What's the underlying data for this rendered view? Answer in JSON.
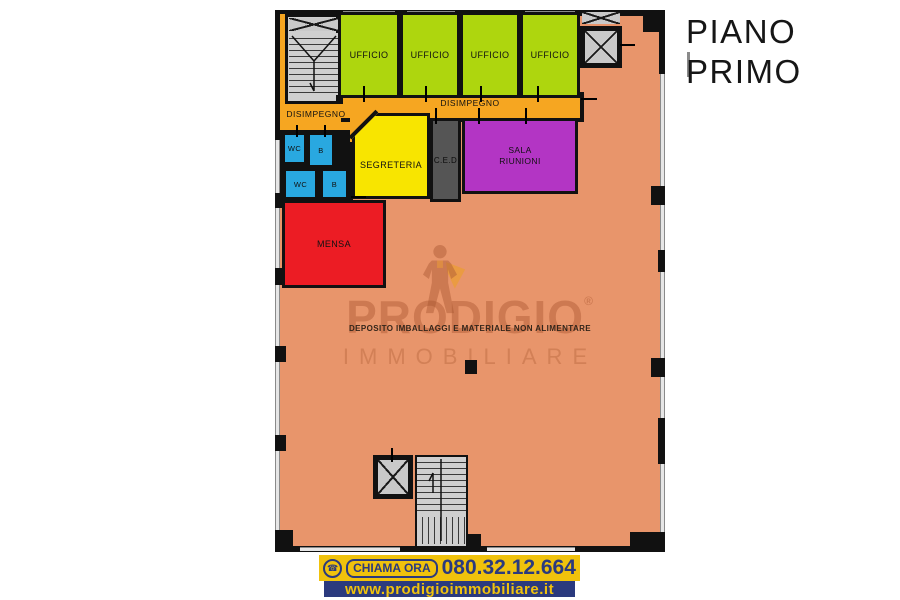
{
  "title": {
    "line1": "PIANO",
    "line2": "PRIMO"
  },
  "floorplan": {
    "offices": [
      {
        "label": "UFFICIO"
      },
      {
        "label": "UFFICIO"
      },
      {
        "label": "UFFICIO"
      },
      {
        "label": "UFFICIO"
      }
    ],
    "disimpegno_left": {
      "label": "DISIMPEGNO"
    },
    "disimpegno_top": {
      "label": "DISIMPEGNO"
    },
    "wc_top": {
      "label": "WC"
    },
    "bath_top": {
      "label": "B"
    },
    "wc_bottom": {
      "label": "WC"
    },
    "bath_bottom": {
      "label": "B"
    },
    "segreteria": {
      "label": "SEGRETERIA"
    },
    "ced": {
      "label": "C.E.D"
    },
    "sala_riunioni": {
      "label": "SALA RIUNIONI"
    },
    "mensa": {
      "label": "MENSA"
    },
    "deposito": {
      "label": "DEPOSITO IMBALLAGGI E MATERIALE NON ALIMENTARE"
    }
  },
  "watermark": {
    "brand": "PRODIGIO",
    "registered": "®",
    "brand_sub": "IMMOBILIARE"
  },
  "footer": {
    "cta_label": "CHIAMA ORA",
    "phone_number": "080.32.12.664",
    "website": "www.prodigioimmobiliare.it"
  },
  "colors": {
    "office_green": "#aed60e",
    "corridor_orange": "#f6a621",
    "segreteria_yellow": "#f8e500",
    "ced_gray": "#555555",
    "meeting_purple": "#b335c4",
    "wc_blue": "#29a8e0",
    "mensa_red": "#ec1c24",
    "deposito_salmon": "#e8956b",
    "wall_black": "#111111",
    "banner_yellow": "#f0c20c",
    "banner_blue": "#2b3a7e"
  }
}
